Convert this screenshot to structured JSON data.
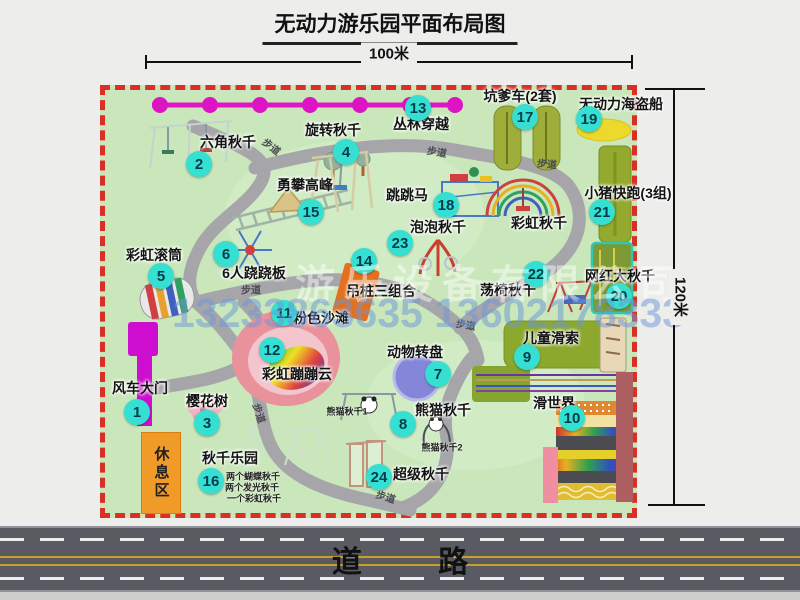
{
  "title": "无动力游乐园平面布局图",
  "dimensions": {
    "width": "100米",
    "height": "120米"
  },
  "road": {
    "label": "道 路"
  },
  "rest_area": {
    "label": "休息区"
  },
  "watermark": {
    "company": "游乐设备有限公司",
    "phone": "13233863635 13602178333"
  },
  "badge_color": "#35e0d2",
  "attractions": [
    {
      "num": "1",
      "name": "风车大门",
      "nx": 137,
      "ny": 412,
      "lx": 140,
      "ly": 388
    },
    {
      "num": "2",
      "name": "六角秋千",
      "nx": 199,
      "ny": 164,
      "lx": 228,
      "ly": 142
    },
    {
      "num": "3",
      "name": "樱花树",
      "nx": 207,
      "ny": 423,
      "lx": 207,
      "ly": 401
    },
    {
      "num": "4",
      "name": "旋转秋千",
      "nx": 346,
      "ny": 152,
      "lx": 333,
      "ly": 130
    },
    {
      "num": "5",
      "name": "彩虹滚筒",
      "nx": 161,
      "ny": 276,
      "lx": 154,
      "ly": 255
    },
    {
      "num": "6",
      "name": "6人跷跷板",
      "nx": 226,
      "ny": 254,
      "lx": 254,
      "ly": 273
    },
    {
      "num": "7",
      "name": "动物转盘",
      "nx": 438,
      "ny": 374,
      "lx": 415,
      "ly": 352
    },
    {
      "num": "8",
      "name": "熊猫秋千",
      "nx": 403,
      "ny": 424,
      "lx": 443,
      "ly": 410
    },
    {
      "num": "9",
      "name": "儿童滑索",
      "nx": 527,
      "ny": 357,
      "lx": 551,
      "ly": 338
    },
    {
      "num": "10",
      "name": "滑世界",
      "nx": 572,
      "ny": 418,
      "lx": 554,
      "ly": 403
    },
    {
      "num": "11",
      "name": "粉色沙滩",
      "nx": 284,
      "ny": 313,
      "lx": 321,
      "ly": 318
    },
    {
      "num": "12",
      "name": "彩虹蹦蹦云",
      "nx": 272,
      "ny": 350,
      "lx": 297,
      "ly": 374
    },
    {
      "num": "13",
      "name": "丛林穿越",
      "nx": 418,
      "ny": 108,
      "lx": 421,
      "ly": 124
    },
    {
      "num": "14",
      "name": "吊桩三组合",
      "nx": 364,
      "ny": 261,
      "lx": 381,
      "ly": 291
    },
    {
      "num": "15",
      "name": "勇攀高峰",
      "nx": 311,
      "ny": 212,
      "lx": 305,
      "ly": 185
    },
    {
      "num": "16",
      "name": "秋千乐园",
      "nx": 211,
      "ny": 481,
      "lx": 230,
      "ly": 458
    },
    {
      "num": "17",
      "name": "坑爹车(2套)",
      "nx": 525,
      "ny": 117,
      "lx": 520,
      "ly": 96
    },
    {
      "num": "18",
      "name": "跳跳马",
      "nx": 446,
      "ny": 205,
      "lx": 407,
      "ly": 195
    },
    {
      "num": "19",
      "name": "无动力海盗船",
      "nx": 589,
      "ny": 119,
      "lx": 621,
      "ly": 104
    },
    {
      "num": "20",
      "name": "网红大秋千",
      "nx": 619,
      "ny": 296,
      "lx": 620,
      "ly": 276
    },
    {
      "num": "21",
      "name": "小猪快跑(3组)",
      "nx": 602,
      "ny": 212,
      "lx": 628,
      "ly": 193
    },
    {
      "num": "22",
      "name": "荡椅秋千",
      "nx": 536,
      "ny": 274,
      "lx": 508,
      "ly": 290
    },
    {
      "num": "23",
      "name": "泡泡秋千",
      "nx": 400,
      "ny": 243,
      "lx": 438,
      "ly": 227
    },
    {
      "num": "24",
      "name": "超级秋千",
      "nx": 379,
      "ny": 477,
      "lx": 421,
      "ly": 474
    }
  ],
  "extra_labels": [
    {
      "text": "彩虹秋千",
      "x": 539,
      "y": 223
    }
  ],
  "small_notes": [
    {
      "text": "熊猫秋千1",
      "x": 347,
      "y": 411
    },
    {
      "text": "熊猫秋千2",
      "x": 442,
      "y": 447
    },
    {
      "text": "两个蝴蝶秋千",
      "x": 253,
      "y": 476
    },
    {
      "text": "两个发光秋千",
      "x": 252,
      "y": 487
    },
    {
      "text": "一个彩虹秋千",
      "x": 254,
      "y": 498
    }
  ],
  "path_labels": [
    {
      "text": "步道",
      "x": 272,
      "y": 146,
      "rot": 38
    },
    {
      "text": "步道",
      "x": 437,
      "y": 151,
      "rot": 10
    },
    {
      "text": "步道",
      "x": 547,
      "y": 163,
      "rot": 5
    },
    {
      "text": "步道",
      "x": 251,
      "y": 289,
      "rot": 0
    },
    {
      "text": "步道",
      "x": 466,
      "y": 324,
      "rot": 10
    },
    {
      "text": "步道",
      "x": 386,
      "y": 496,
      "rot": 18
    },
    {
      "text": "步道",
      "x": 260,
      "y": 413,
      "rot": 72
    }
  ]
}
